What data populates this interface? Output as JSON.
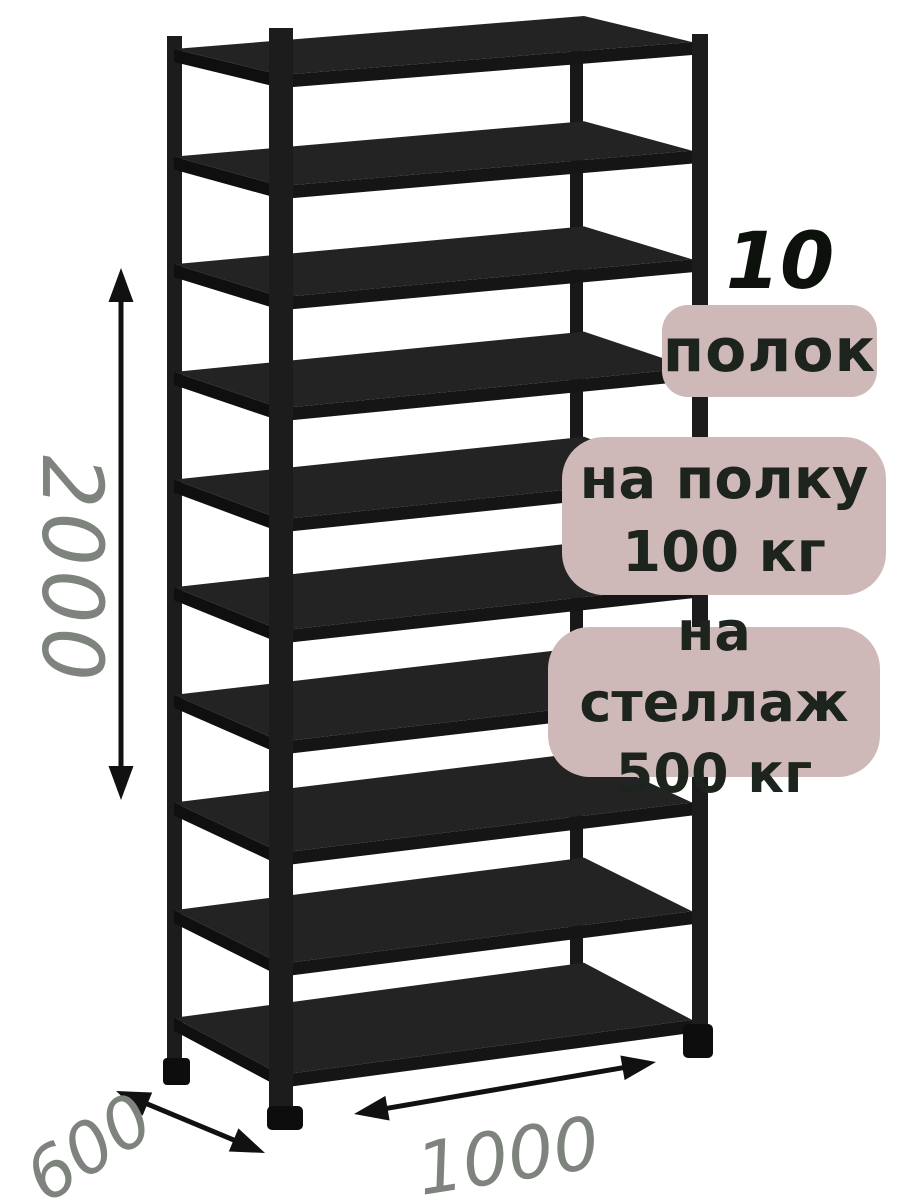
{
  "badges": {
    "count_number": "10",
    "count_label": "полок",
    "shelf_load_line1": "на полку",
    "shelf_load_line2": "100 кг",
    "rack_load_line1": "на стеллаж",
    "rack_load_line2": "500 кг"
  },
  "dimensions": {
    "height_mm": "2000",
    "depth_mm": "600",
    "width_mm": "1000"
  },
  "rack": {
    "shelf_count": 10
  },
  "colors": {
    "background": "#ffffff",
    "badge_bg": "#cfb9b8",
    "badge_text": "#1d241d",
    "count_text": "#0c110c",
    "dim_text": "#7e837e",
    "rack_black": "#1c1c1c",
    "arrow_black": "#111111"
  }
}
